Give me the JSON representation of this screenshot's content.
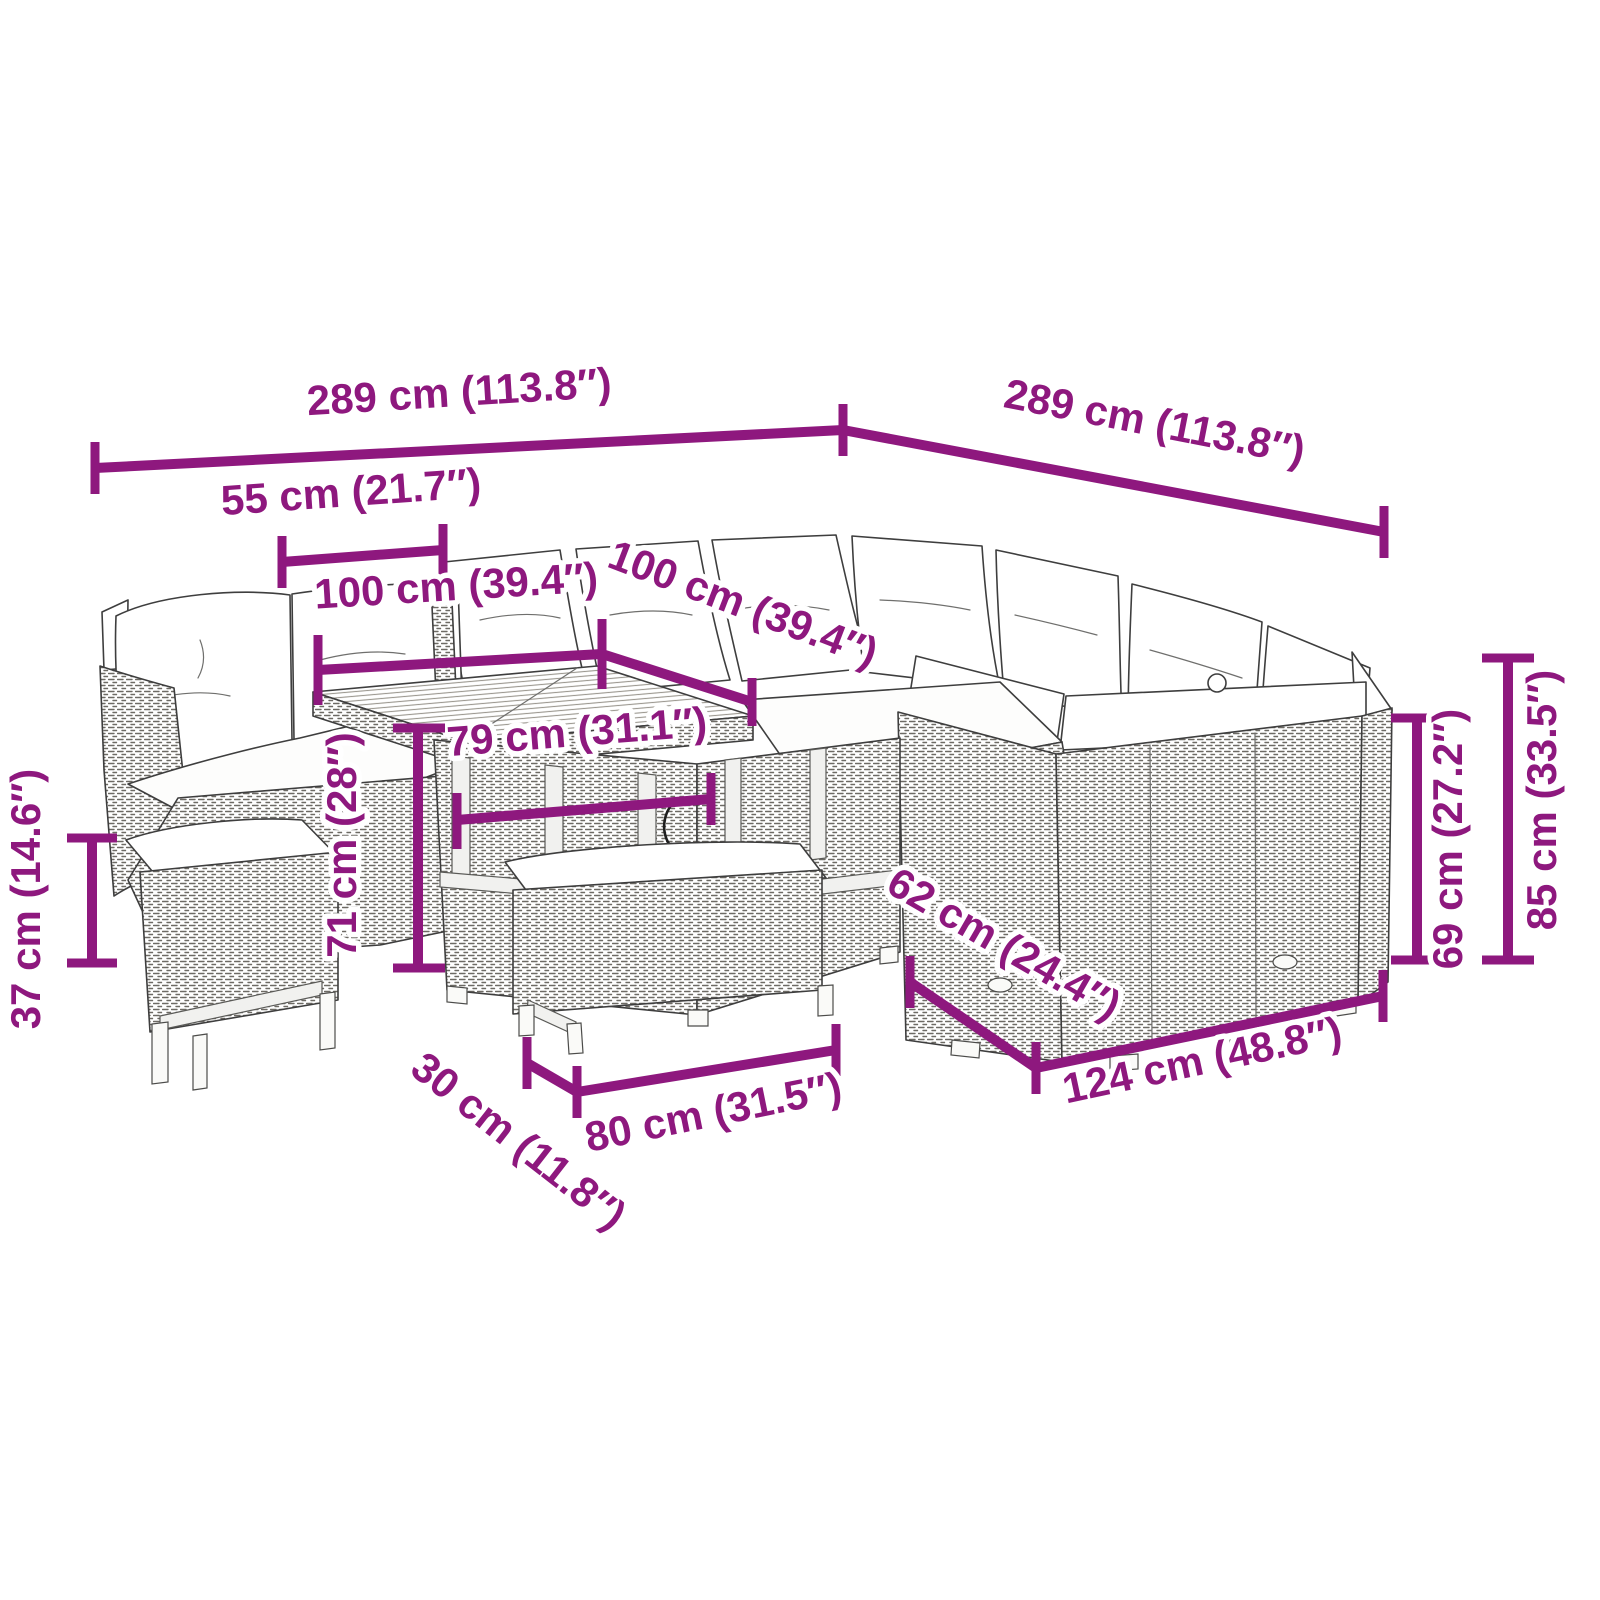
{
  "diagram": {
    "accent_color": "#8E187E",
    "linework_color": "#3e3e3e"
  },
  "dims": {
    "width_total_left": {
      "label": "289 cm (113.8″)"
    },
    "width_total_right": {
      "label": "289 cm (113.8″)"
    },
    "corner_seat_width": {
      "label": "55 cm (21.7″)"
    },
    "table_length": {
      "label": "100 cm (39.4″)"
    },
    "table_depth": {
      "label": "100 cm (39.4″)"
    },
    "table_frame_width": {
      "label": "79 cm (31.1″)"
    },
    "table_height": {
      "label": "71 cm (28″)"
    },
    "bench_height": {
      "label": "37 cm (14.6″)"
    },
    "seat_depth": {
      "label": "62 cm (24.4″)"
    },
    "module_length": {
      "label": "124 cm (48.8″)"
    },
    "back_height": {
      "label": "69 cm (27.2″)"
    },
    "total_height": {
      "label": "85 cm (33.5″)"
    },
    "bench_depth": {
      "label": "30 cm (11.8″)"
    },
    "bench_length": {
      "label": "80 cm (31.5″)"
    }
  }
}
